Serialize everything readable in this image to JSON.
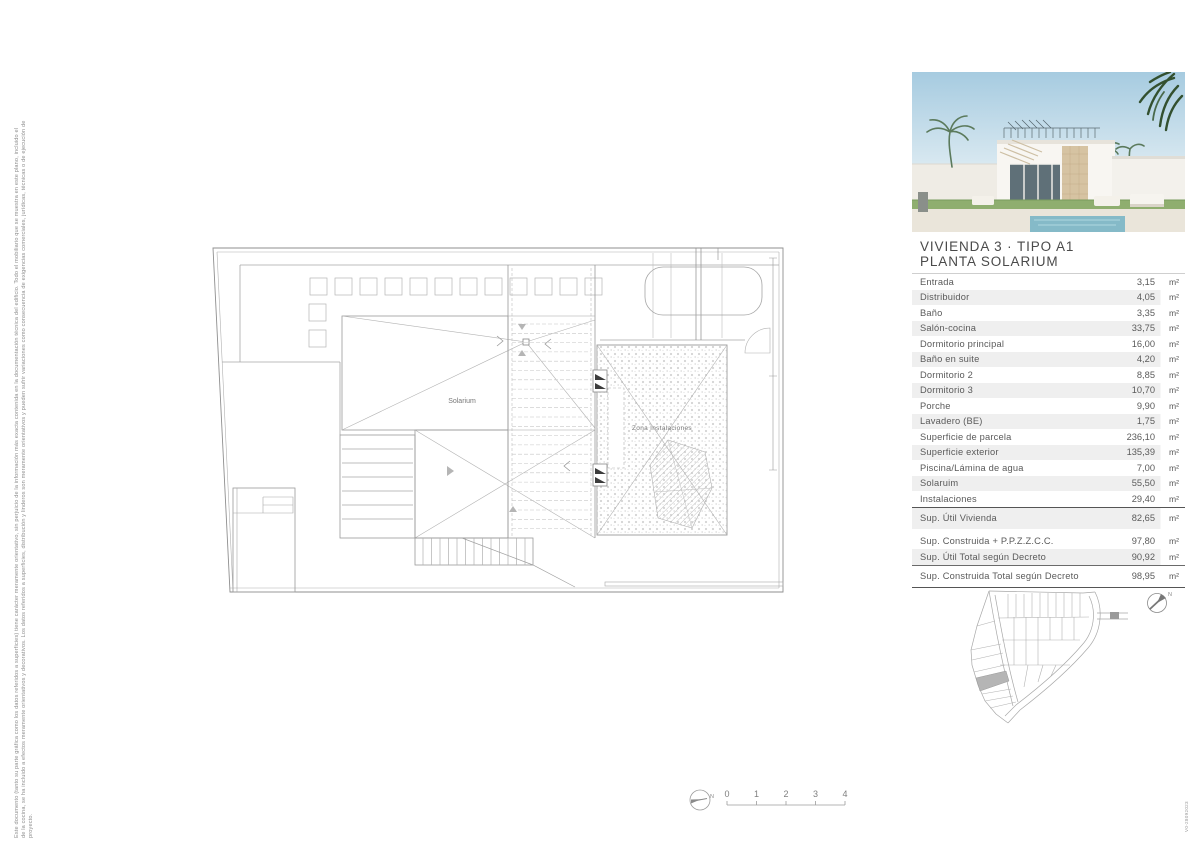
{
  "sheet": {
    "disclaimer_line1": "Este documento (tanto su parte gráfica como los datos referidos a superficies) tiene carácter meramente orientativo, sin perjuicio de la información más exacta contenida en la documentación técnica del edificio. Todo el mobiliario que se muestra en este plano, incluido el",
    "disclaimer_line2": "de la cocina, se ha incluido a efectos meramente orientativos y decorativos. Los datos referidos a superficies, distribución y linderos son meramente orientativos y pueden sufrir variaciones como consecuencia de exigencias comerciales, jurídicas, técnicas o de ejecución de",
    "disclaimer_line3": "proyecto.",
    "version": "V0-28092023"
  },
  "plan": {
    "label_solarium": "Solarium",
    "label_zona": "Zona Instalaciones",
    "north_label": "N",
    "scale_ticks": [
      "0",
      "1",
      "2",
      "3",
      "4"
    ]
  },
  "panel": {
    "title_line1": "VIVIENDA 3 · TIPO A1",
    "title_line2": "PLANTA SOLARIUM",
    "rooms": [
      {
        "label": "Entrada",
        "value": "3,15",
        "unit": "m²"
      },
      {
        "label": "Distribuidor",
        "value": "4,05",
        "unit": "m²"
      },
      {
        "label": "Baño",
        "value": "3,35",
        "unit": "m²"
      },
      {
        "label": "Salón-cocina",
        "value": "33,75",
        "unit": "m²"
      },
      {
        "label": "Dormitorio principal",
        "value": "16,00",
        "unit": "m²"
      },
      {
        "label": "Baño en suite",
        "value": "4,20",
        "unit": "m²"
      },
      {
        "label": "Dormitorio 2",
        "value": "8,85",
        "unit": "m²"
      },
      {
        "label": "Dormitorio 3",
        "value": "10,70",
        "unit": "m²"
      },
      {
        "label": "Porche",
        "value": "9,90",
        "unit": "m²"
      },
      {
        "label": "Lavadero (BE)",
        "value": "1,75",
        "unit": "m²"
      },
      {
        "label": "Superficie de parcela",
        "value": "236,10",
        "unit": "m²"
      },
      {
        "label": "Superficie exterior",
        "value": "135,39",
        "unit": "m²"
      },
      {
        "label": "Piscina/Lámina de agua",
        "value": "7,00",
        "unit": "m²"
      },
      {
        "label": "Solaruim",
        "value": "55,50",
        "unit": "m²"
      },
      {
        "label": "Instalaciones",
        "value": "29,40",
        "unit": "m²"
      }
    ],
    "summary": [
      {
        "label": "Sup. Útil Vivienda",
        "value": "82,65",
        "unit": "m²"
      },
      {
        "label": "Sup. Construida + P.P.Z.Z.C.C.",
        "value": "97,80",
        "unit": "m²"
      },
      {
        "label": "Sup. Útil Total según Decreto",
        "value": "90,92",
        "unit": "m²"
      },
      {
        "label": "Sup. Construida Total según Decreto",
        "value": "98,95",
        "unit": "m²"
      }
    ],
    "sitemap_north_label": "N"
  }
}
